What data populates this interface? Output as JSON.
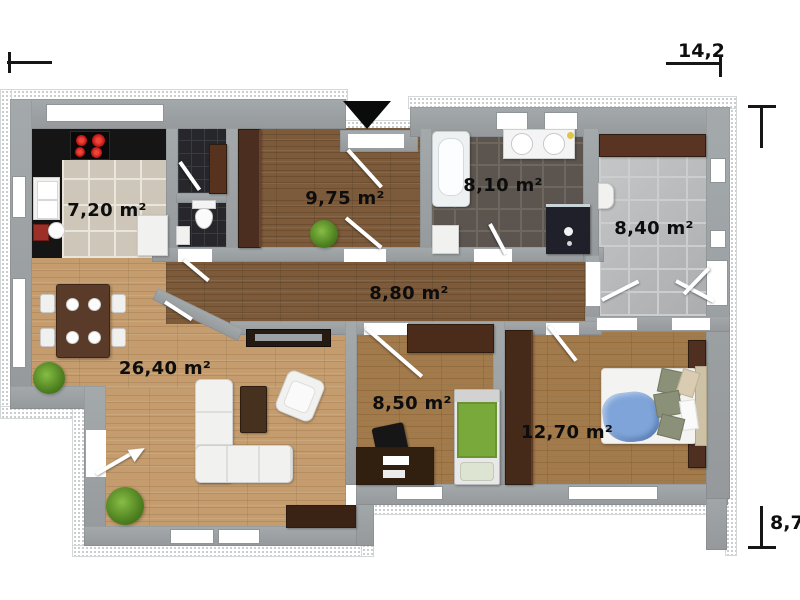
{
  "floorplan": {
    "rooms": {
      "kitchen": "7,20 m²",
      "hall": "9,75 m²",
      "bathroom": "8,10 m²",
      "storage_room": "8,40 m²",
      "corridor": "8,80 m²",
      "living_room": "26,40 m²",
      "small_bedroom": "8,50 m²",
      "bedroom": "12,70 m²"
    },
    "dimensions": {
      "width": "14,2",
      "height": "8,7"
    }
  }
}
